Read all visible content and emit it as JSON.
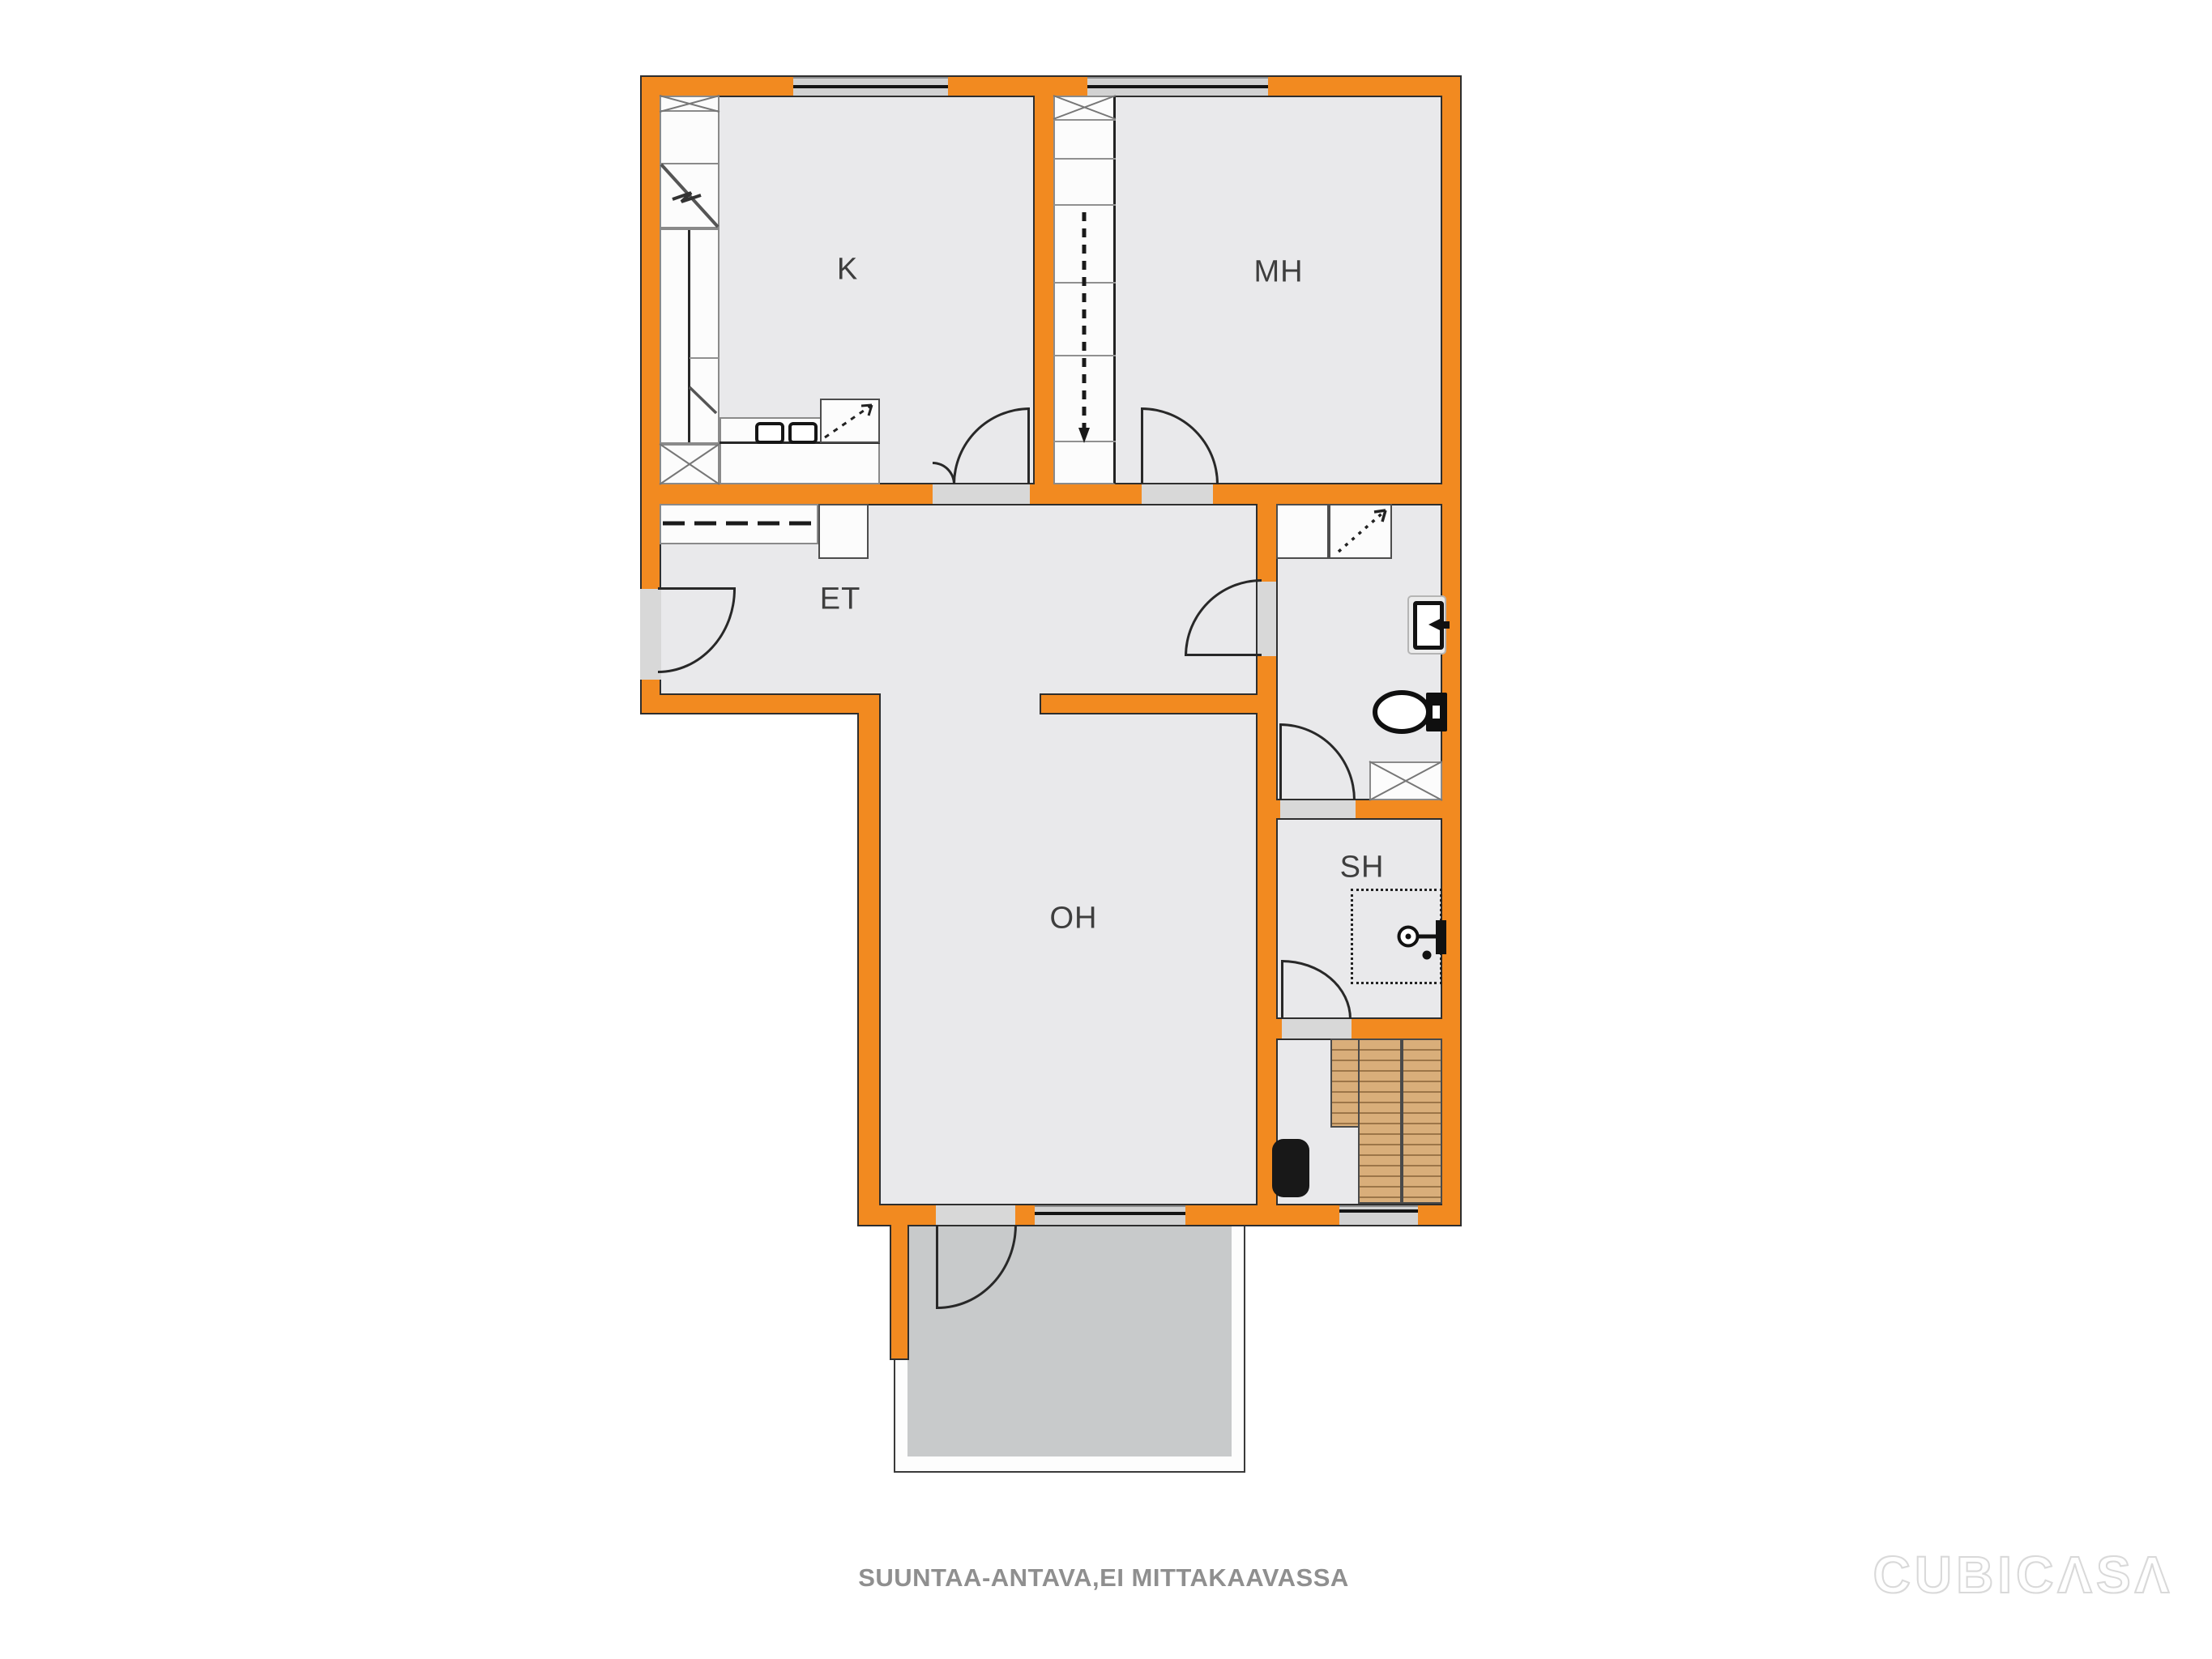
{
  "plan": {
    "rooms": [
      {
        "id": "k",
        "label": "K"
      },
      {
        "id": "mh",
        "label": "MH"
      },
      {
        "id": "et",
        "label": "ET"
      },
      {
        "id": "oh",
        "label": "OH"
      },
      {
        "id": "sh",
        "label": "SH"
      }
    ],
    "footer_note": "SUUNTAA-ANTAVA,EI MITTAKAAVASSA",
    "watermark": "CUBICΛSΛ",
    "colors": {
      "wall": "#F28A20",
      "wall_outline": "#2E2E2E",
      "floor": "#E9E9EB",
      "balcony_floor": "#C8CACB",
      "threshold": "#D8D8D8",
      "window_band": "#D2D2D2",
      "wood_bench": "#D9AE7A",
      "label_text": "#3E3E3E",
      "footer_text": "#8F8F8F"
    }
  }
}
